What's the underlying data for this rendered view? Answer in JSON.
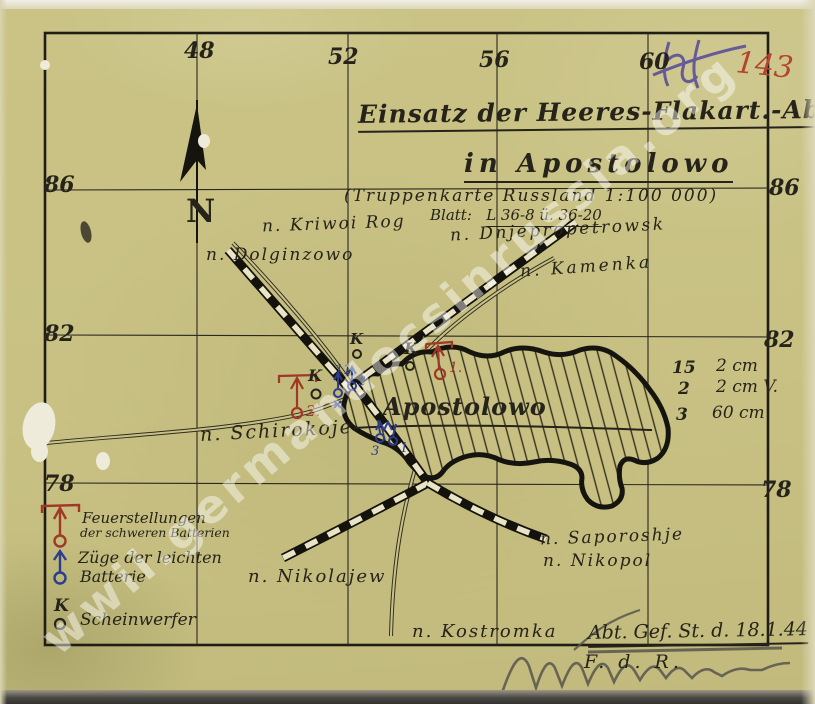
{
  "watermark": "wwii.germandocsinrussia.org",
  "corner_marks": {
    "page_number": "143"
  },
  "grid": {
    "top": [
      "48",
      "52",
      "56",
      "60"
    ],
    "left": [
      "86",
      "82",
      "78"
    ],
    "right": [
      "86",
      "82",
      "78"
    ]
  },
  "compass_label": "N",
  "title_block": {
    "line1": "Einsatz der Heeres-Flakart.-Abt.301",
    "line2": "in Apostolowo",
    "line3": "(Truppenkarte Russland 1:100 000)",
    "blatt_label": "Blatt:",
    "blatt_value": "L 36-8 ü. 36-20"
  },
  "places": {
    "kriwoi_rog": "n. Kriwoi Rog",
    "dnjepropetrowsk": "n. Dnjepropetrowsk",
    "kamenka": "n. Kamenka",
    "dolginzowo": "n. Dolginzowo",
    "schirokoje": "n. Schirokoje",
    "nikolajew": "n. Nikolajew",
    "saporoshje": "n. Saporoshje",
    "nikopol": "n. Nikopol",
    "kostromka": "n. Kostromka",
    "apostolowo": "Apostolowo"
  },
  "equipment": {
    "rows": [
      {
        "count": "15",
        "caliber": "2 cm"
      },
      {
        "count": "2",
        "caliber": "2 cm V."
      },
      {
        "count": "3",
        "caliber": "60 cm"
      }
    ]
  },
  "legend": {
    "heavy": {
      "line1": "Feuerstellungen",
      "line2": "der schweren Batterien"
    },
    "light": {
      "line1": "Züge der leichten",
      "line2": "Batterie"
    },
    "searchlight": {
      "line1": "Scheinwerfer"
    }
  },
  "map_symbols": {
    "searchlight_letter": "K",
    "red_pos_1": "1.",
    "red_pos_2": "2.",
    "blue_west_mark": "11",
    "blue_west_num": "2",
    "blue_south_left": "3",
    "blue_south_right": "1"
  },
  "footer": {
    "hq_note": "Abt. Gef. St. d. 18.1.44",
    "certify": "F. d. R."
  },
  "colors": {
    "paper": "#c8c183",
    "ink": "#26231a",
    "red_ink": "#a03826",
    "blue_ink": "#2b3d8c",
    "red_pencil": "#b5442e",
    "purple_pencil": "#54489a",
    "graphite": "#59554e"
  }
}
